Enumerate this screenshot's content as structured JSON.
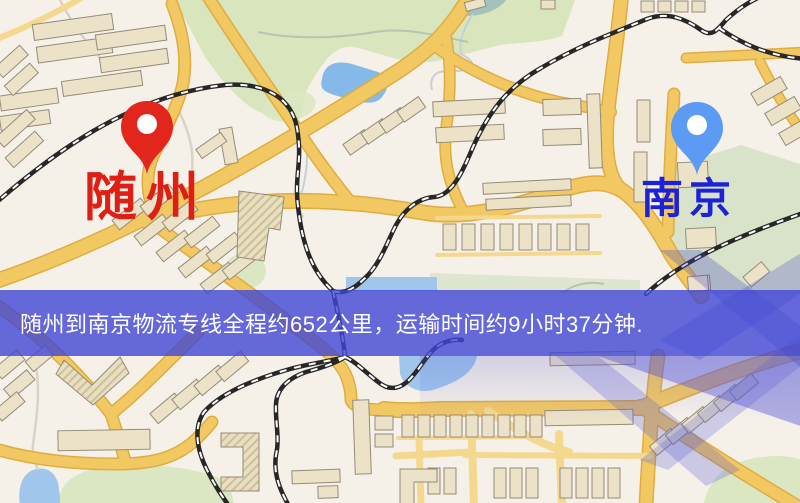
{
  "banner": {
    "text": "随州到南京物流专线全程约652公里，运输时间约9小时37分钟."
  },
  "markers": {
    "origin": {
      "name": "随州",
      "pin_icon": "red-map-pin-icon"
    },
    "destination": {
      "name": "南京",
      "pin_icon": "blue-map-pin-icon"
    }
  },
  "colors": {
    "map-bg": "#f6f1e8",
    "road": "#f2c863",
    "road-casing": "#e0ac42",
    "road-light": "#f4d88e",
    "building-fill": "#ece2c8",
    "building-stroke": "#948b7a",
    "rail": "#272727",
    "water": "#85b9e9",
    "water-light": "#a0c6ec",
    "river-teal": "#a2c2ba",
    "green": "#d8e5bd",
    "green-bright": "#dbe7c2",
    "green-sage": "#d9e3c9",
    "banner-bg": "rgba(64,70,212,0.8)",
    "banner-text": "#ffffff",
    "origin-pin": "#e3261c",
    "origin-label": "#dd1f14",
    "dest-pin": "#5b9bf3",
    "dest-label": "#1c22d8"
  }
}
